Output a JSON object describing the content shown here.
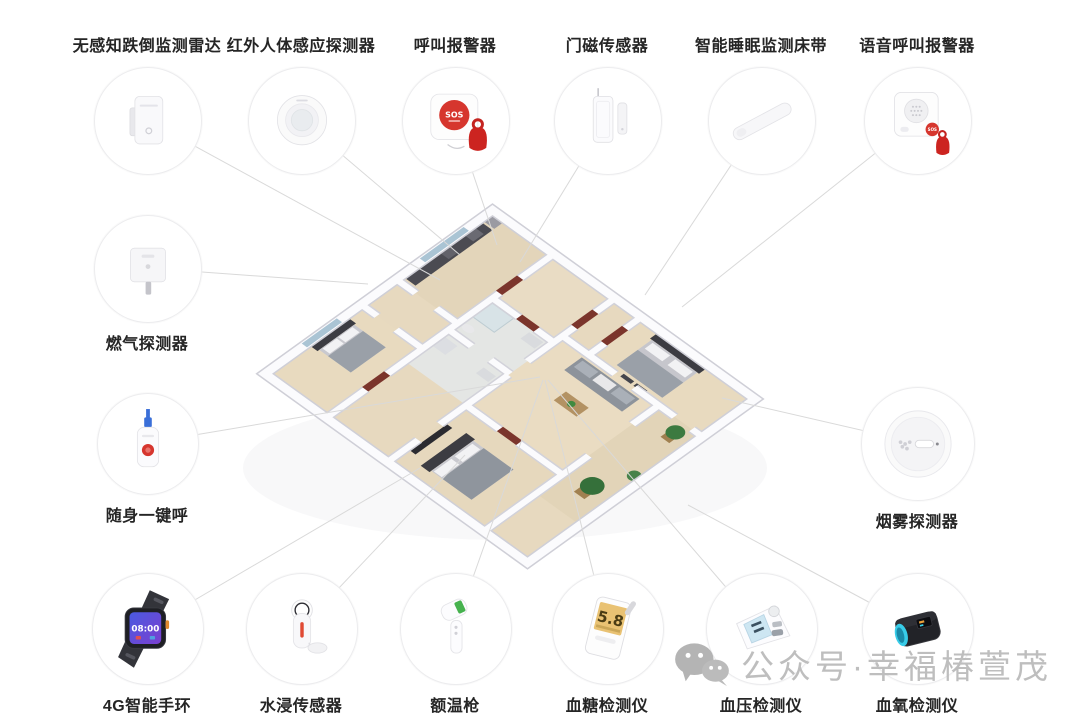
{
  "watermark": {
    "icon": "wechat",
    "text": "公众号·幸福椿萱茂"
  },
  "colors": {
    "accent_red": "#d6362e",
    "connector_line": "#d9d9d9",
    "label_text": "#252525",
    "watermark_gray": "#b9b9b9"
  },
  "devices": {
    "top_row": [
      {
        "id": "fall-radar",
        "label": "无感知跌倒监测雷达"
      },
      {
        "id": "pir-motion-sensor",
        "label": "红外人体感应探测器"
      },
      {
        "id": "sos-call-alarm",
        "label": "呼叫报警器",
        "button_text": "SOS"
      },
      {
        "id": "door-magnet-sensor",
        "label": "门磁传感器"
      },
      {
        "id": "sleep-monitor-strip",
        "label": "智能睡眠监测床带"
      },
      {
        "id": "voice-call-alarm",
        "label": "语音呼叫报警器",
        "badge_text": "SOS"
      }
    ],
    "left_column": [
      {
        "id": "gas-detector",
        "label": "燃气探测器"
      },
      {
        "id": "portable-sos-button",
        "label": "随身一键呼"
      }
    ],
    "right_column": [
      {
        "id": "smoke-detector",
        "label": "烟雾探测器"
      }
    ],
    "bottom_row": [
      {
        "id": "smart-watch-4g",
        "label": "4G智能手环",
        "screen_time": "08:00"
      },
      {
        "id": "water-leak-sensor",
        "label": "水浸传感器"
      },
      {
        "id": "forehead-thermometer",
        "label": "额温枪"
      },
      {
        "id": "glucose-meter",
        "label": "血糖检测仪",
        "screen_value": "5.8"
      },
      {
        "id": "bp-monitor",
        "label": "血压检测仪"
      },
      {
        "id": "pulse-oximeter",
        "label": "血氧检测仪"
      }
    ]
  }
}
